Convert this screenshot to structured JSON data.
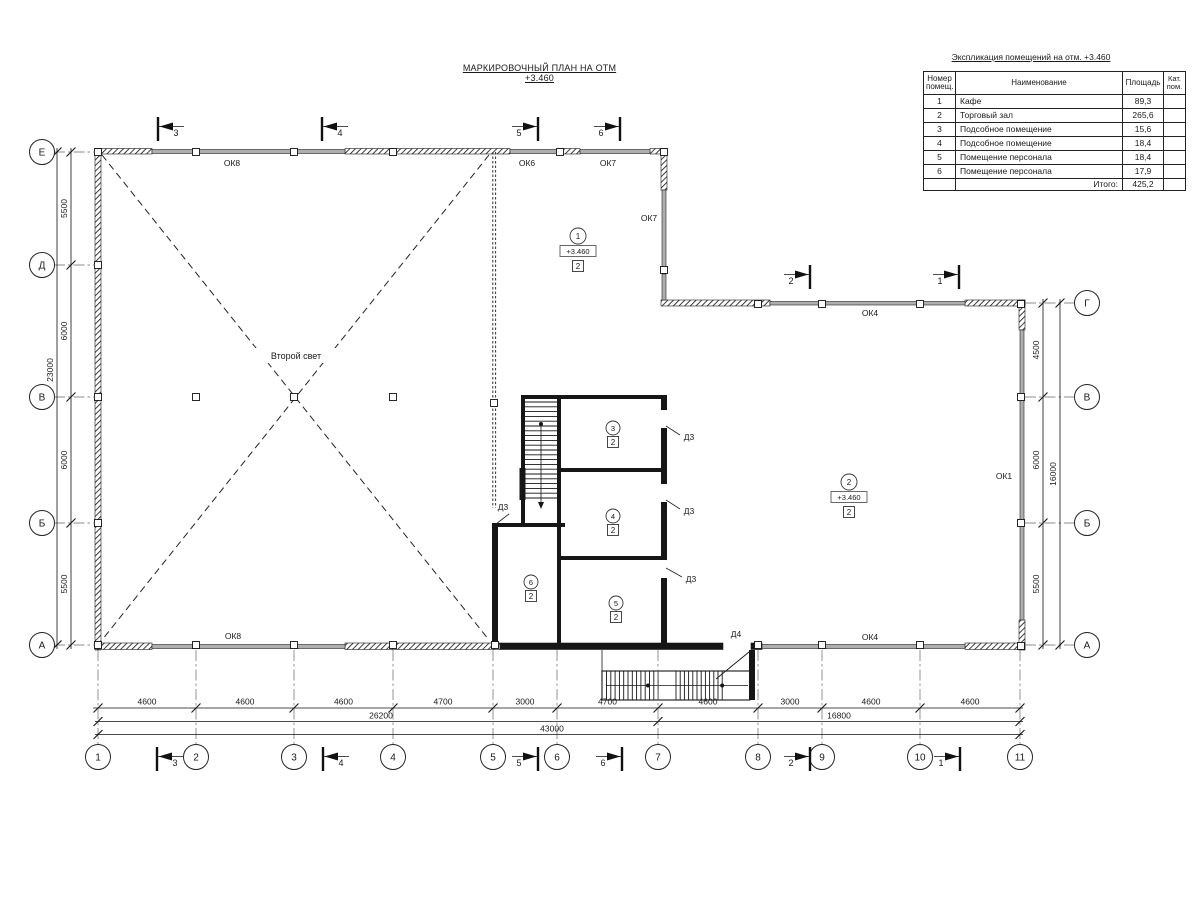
{
  "plan_title": "МАРКИРОВОЧНЫЙ ПЛАН НА ОТМ +3.460",
  "legend": {
    "title": "Экспликация помещений на отм. +3.460",
    "col_number": "Номер помещ.",
    "col_name": "Наименование",
    "col_area": "Площадь",
    "col_cat": "Кат. пом.",
    "rows": [
      {
        "num": "1",
        "name": "Кафе",
        "area": "89,3",
        "cat": ""
      },
      {
        "num": "2",
        "name": "Торговый зал",
        "area": "265,6",
        "cat": ""
      },
      {
        "num": "3",
        "name": "Подсобное помещение",
        "area": "15,6",
        "cat": ""
      },
      {
        "num": "4",
        "name": "Подсобное помещение",
        "area": "18,4",
        "cat": ""
      },
      {
        "num": "5",
        "name": "Помещение персонала",
        "area": "18,4",
        "cat": ""
      },
      {
        "num": "6",
        "name": "Помещение персонала",
        "area": "17,9",
        "cat": ""
      }
    ],
    "total_label": "Итого:",
    "total_area": "425,2"
  },
  "plan": {
    "second_light": "Второй свет",
    "axis_left": [
      "Е",
      "Д",
      "В",
      "Б",
      "А"
    ],
    "axis_right": [
      "Г",
      "В",
      "Б",
      "А"
    ],
    "axis_bottom": [
      "1",
      "2",
      "3",
      "4",
      "5",
      "6",
      "7",
      "8",
      "9",
      "10",
      "11"
    ],
    "dim_left": [
      "5500",
      "6000",
      "6000",
      "5500"
    ],
    "dim_left_total": "23000",
    "dim_right": [
      "4500",
      "6000",
      "5500"
    ],
    "dim_right_total": "16000",
    "dim_bottom": [
      "4600",
      "4600",
      "4600",
      "4700",
      "3000",
      "4700",
      "4600",
      "3000",
      "4600",
      "4600"
    ],
    "dim_bottom_sub1": "26200",
    "dim_bottom_sub2": "16800",
    "dim_bottom_total": "43000",
    "sections_top": [
      "3",
      "4",
      "5",
      "6"
    ],
    "sections_top_right": [
      "2",
      "1"
    ],
    "sections_bottom": [
      "3",
      "4",
      "5",
      "6",
      "2",
      "1"
    ],
    "windows": {
      "ok8_top": "ОК8",
      "ok6_top": "ОК6",
      "ok7_top": "ОК7",
      "ok7_side": "ОК7",
      "ok8_bottom": "ОК8",
      "ok4_top": "ОК4",
      "ok4_bottom": "ОК4",
      "ok1_right": "ОК1"
    },
    "doors": {
      "d3": "Д3",
      "d4": "Д4"
    },
    "rooms": {
      "r1": {
        "num": "1",
        "elev": "+3.460",
        "type": "2"
      },
      "r2": {
        "num": "2",
        "elev": "+3.460",
        "type": "2"
      },
      "r3": {
        "num": "3",
        "type": "2"
      },
      "r4": {
        "num": "4",
        "type": "2"
      },
      "r5": {
        "num": "5",
        "type": "2"
      },
      "r6": {
        "num": "6",
        "type": "2"
      }
    }
  }
}
